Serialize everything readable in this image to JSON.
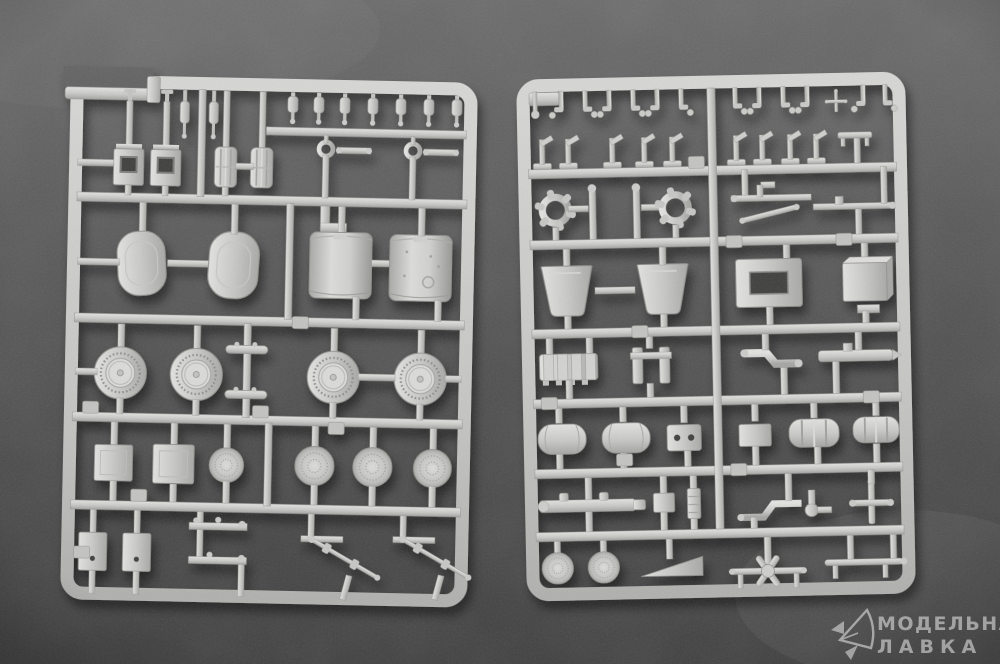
{
  "scene": {
    "type": "photograph",
    "subject": "two grey plastic model-kit sprues on a dark surface",
    "colors": {
      "background_top": "#6a6a6a",
      "background_bottom": "#3f3f3f",
      "plastic": "#c8c8c6",
      "plastic_highlight": "#e2e2e0",
      "plastic_shadow": "#a4a4a2",
      "watermark": "#dedede"
    }
  },
  "watermark": {
    "line1": "МОДЕЛЬНАЯ",
    "line2": "ЛАВКА",
    "logo_icon": "paper-plane-logo"
  }
}
